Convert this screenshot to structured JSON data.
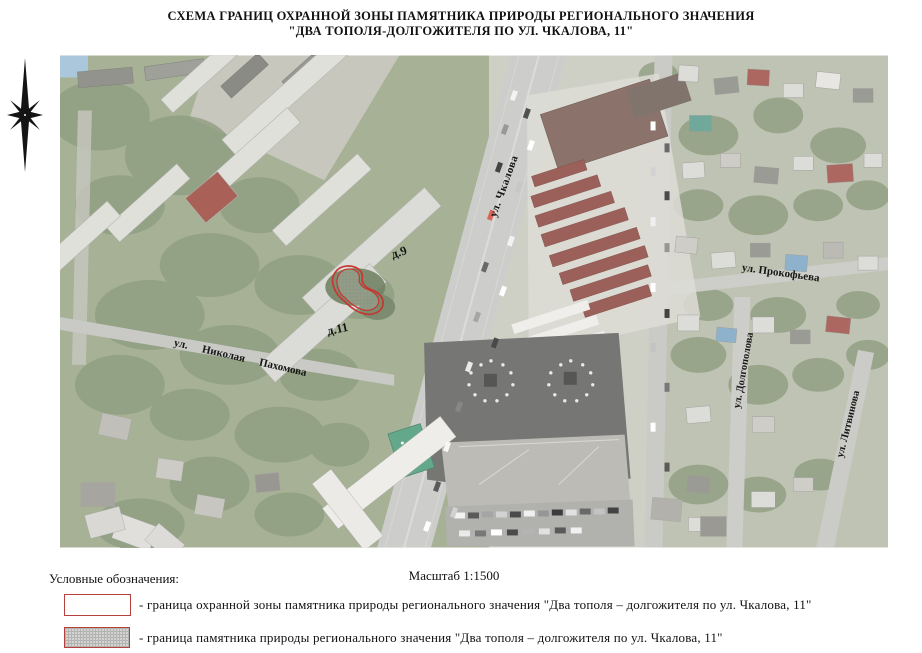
{
  "title": {
    "line1": "СХЕМА ГРАНИЦ ОХРАННОЙ ЗОНЫ ПАМЯТНИКА ПРИРОДЫ РЕГИОНАЛЬНОГО ЗНАЧЕНИЯ",
    "line2": "\"ДВА ТОПОЛЯ-ДОЛГОЖИТЕЛЯ ПО УЛ. ЧКАЛОВА, 11\""
  },
  "map": {
    "street_labels": [
      {
        "label": "ул. Чкалова"
      },
      {
        "label": "ул. Прокофьева"
      },
      {
        "label": "ул. Николая Пахомова"
      },
      {
        "label": "ул. Долгополова"
      },
      {
        "label": "ул. Литвинова"
      }
    ],
    "house_labels": [
      {
        "label": "д.9"
      },
      {
        "label": "д.11"
      }
    ]
  },
  "scale_label": "Масштаб 1:1500",
  "legend": {
    "heading": "Условные обозначения:",
    "items": [
      {
        "swatch": "protection-zone-boundary",
        "label": "- граница охранной зоны памятника природы регионального значения \"Два тополя – долгожителя по ул. Чкалова, 11\""
      },
      {
        "swatch": "monument-boundary",
        "label": "- граница памятника природы регионального значения \"Два тополя – долгожителя по ул. Чкалова, 11\""
      }
    ]
  },
  "icons": {
    "north_arrow": "compass-north-arrow"
  },
  "colors": {
    "boundary_red": "#c5372f",
    "legend_border_red": "#b5403c",
    "map_green": "#96a584",
    "road_gray": "#c7c8c4"
  }
}
